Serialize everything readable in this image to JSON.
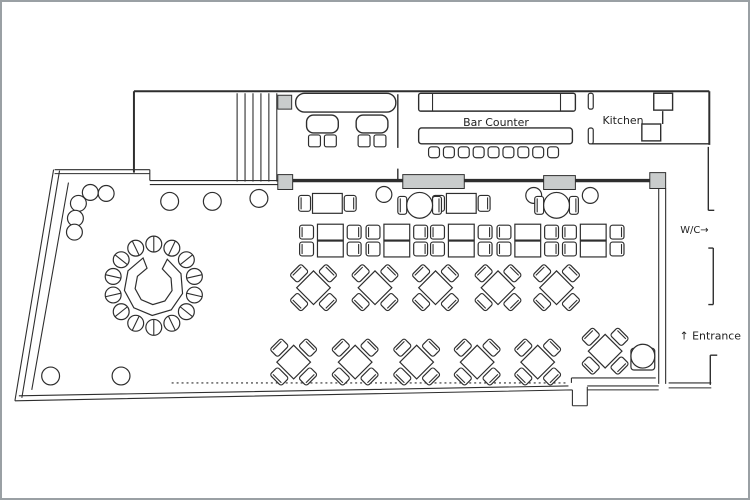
{
  "floorplan": {
    "labels": {
      "bar_counter": "Bar Counter",
      "kitchen": "Kitchen",
      "wc": "W/C→",
      "entrance": "↑ Entrance"
    },
    "colors": {
      "line": "#2e2e2e",
      "planter_fill": "#c9cccc",
      "background": "#ffffff",
      "frame_border": "#9aa0a4"
    },
    "bar": {
      "stool_count": 9,
      "stool_x_start": 429,
      "stool_y": 146,
      "stool_step": 15,
      "stool_size": 11
    },
    "stairs": {
      "line_count": 6,
      "x_start": 236,
      "x_step": 8,
      "y_top": 92,
      "y_bottom": 181
    },
    "lounge": {
      "seat_centers_x": [
        322,
        372
      ]
    },
    "booth_row": {
      "y": 224,
      "centers_x": [
        330,
        397,
        462,
        529,
        595
      ]
    },
    "two_top_tables": [
      {
        "x": 327,
        "y": 203
      },
      {
        "x": 462,
        "y": 203
      }
    ],
    "round_tables": [
      {
        "x": 420,
        "y": 205
      },
      {
        "x": 558,
        "y": 205
      }
    ],
    "diagonal_tables": [
      {
        "x": 313,
        "y": 288
      },
      {
        "x": 375,
        "y": 288
      },
      {
        "x": 436,
        "y": 288
      },
      {
        "x": 499,
        "y": 288
      },
      {
        "x": 558,
        "y": 288
      },
      {
        "x": 293,
        "y": 363
      },
      {
        "x": 355,
        "y": 363
      },
      {
        "x": 417,
        "y": 363
      },
      {
        "x": 478,
        "y": 363
      },
      {
        "x": 539,
        "y": 363
      },
      {
        "x": 607,
        "y": 352
      }
    ],
    "entrance_table": {
      "x": 633,
      "y": 349,
      "w": 24,
      "h": 22,
      "circle_cx": 645,
      "circle_cy": 357,
      "circle_r": 12
    },
    "round_bar": {
      "cx": 152,
      "cy": 286,
      "r_outer": 30,
      "r_inner": 19,
      "stool_count": 14,
      "stool_r": 8,
      "stool_ring_r": 42
    },
    "posts": [
      {
        "x": 88,
        "y": 192,
        "r": 8
      },
      {
        "x": 104,
        "y": 193,
        "r": 8
      },
      {
        "x": 76,
        "y": 203,
        "r": 8
      },
      {
        "x": 73,
        "y": 218,
        "r": 8
      },
      {
        "x": 72,
        "y": 232,
        "r": 8
      },
      {
        "x": 168,
        "y": 201,
        "r": 9
      },
      {
        "x": 211,
        "y": 201,
        "r": 9
      },
      {
        "x": 258,
        "y": 198,
        "r": 9
      },
      {
        "x": 384,
        "y": 194,
        "r": 8
      },
      {
        "x": 535,
        "y": 195,
        "r": 8
      },
      {
        "x": 592,
        "y": 195,
        "r": 8
      },
      {
        "x": 48,
        "y": 377,
        "r": 9
      },
      {
        "x": 119,
        "y": 377,
        "r": 9
      }
    ]
  }
}
